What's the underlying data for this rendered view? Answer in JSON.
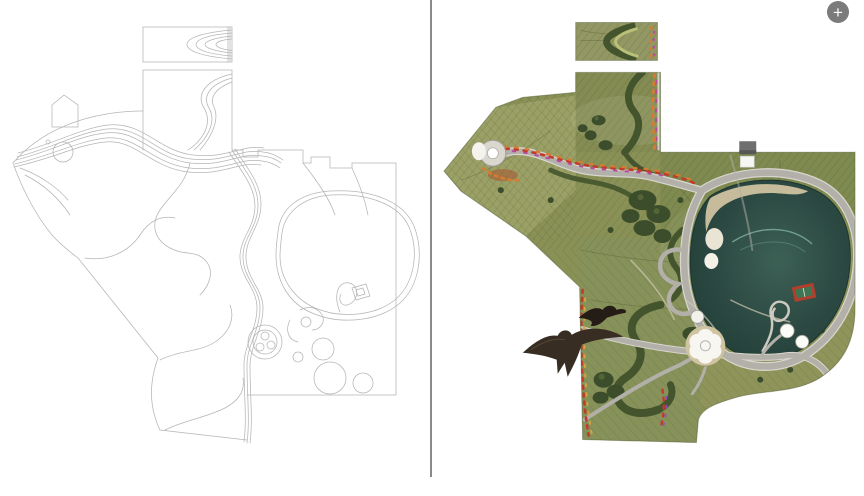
{
  "viewer": {
    "background": "#ffffff",
    "divider_color": "#8a8a8a",
    "zoom_button": {
      "glyph": "+",
      "icon": "plus-icon",
      "bg": "#7b7b7b",
      "fg": "#ffffff"
    }
  },
  "left_panel": {
    "content": "park-masterplan-line-drawing",
    "stroke_color": "#b5b5b5",
    "stroke_color_dark": "#9e9e9e"
  },
  "right_panel": {
    "content": "park-masterplan-rendered-aerial",
    "palette": {
      "field": "#8a9157",
      "field_light": "#9aa066",
      "field_band": "#7e8a50",
      "field_se": "#8f945b",
      "trees": "#3b4d2a",
      "hedge": "#44552e",
      "road": "#b2b0a8",
      "road_casing": "#d8d6cf",
      "lake": "#2f4f47",
      "sand": "#cfc3a0",
      "court": "#b23f2c",
      "court_inner": "#3f7553",
      "flower_red": "#c23b2a",
      "flower_orange": "#d97b2f",
      "flower_pink": "#b9499e",
      "building": "#6f6f6f",
      "bird": "#372d22",
      "plaza_white": "#f7f6f1"
    }
  }
}
